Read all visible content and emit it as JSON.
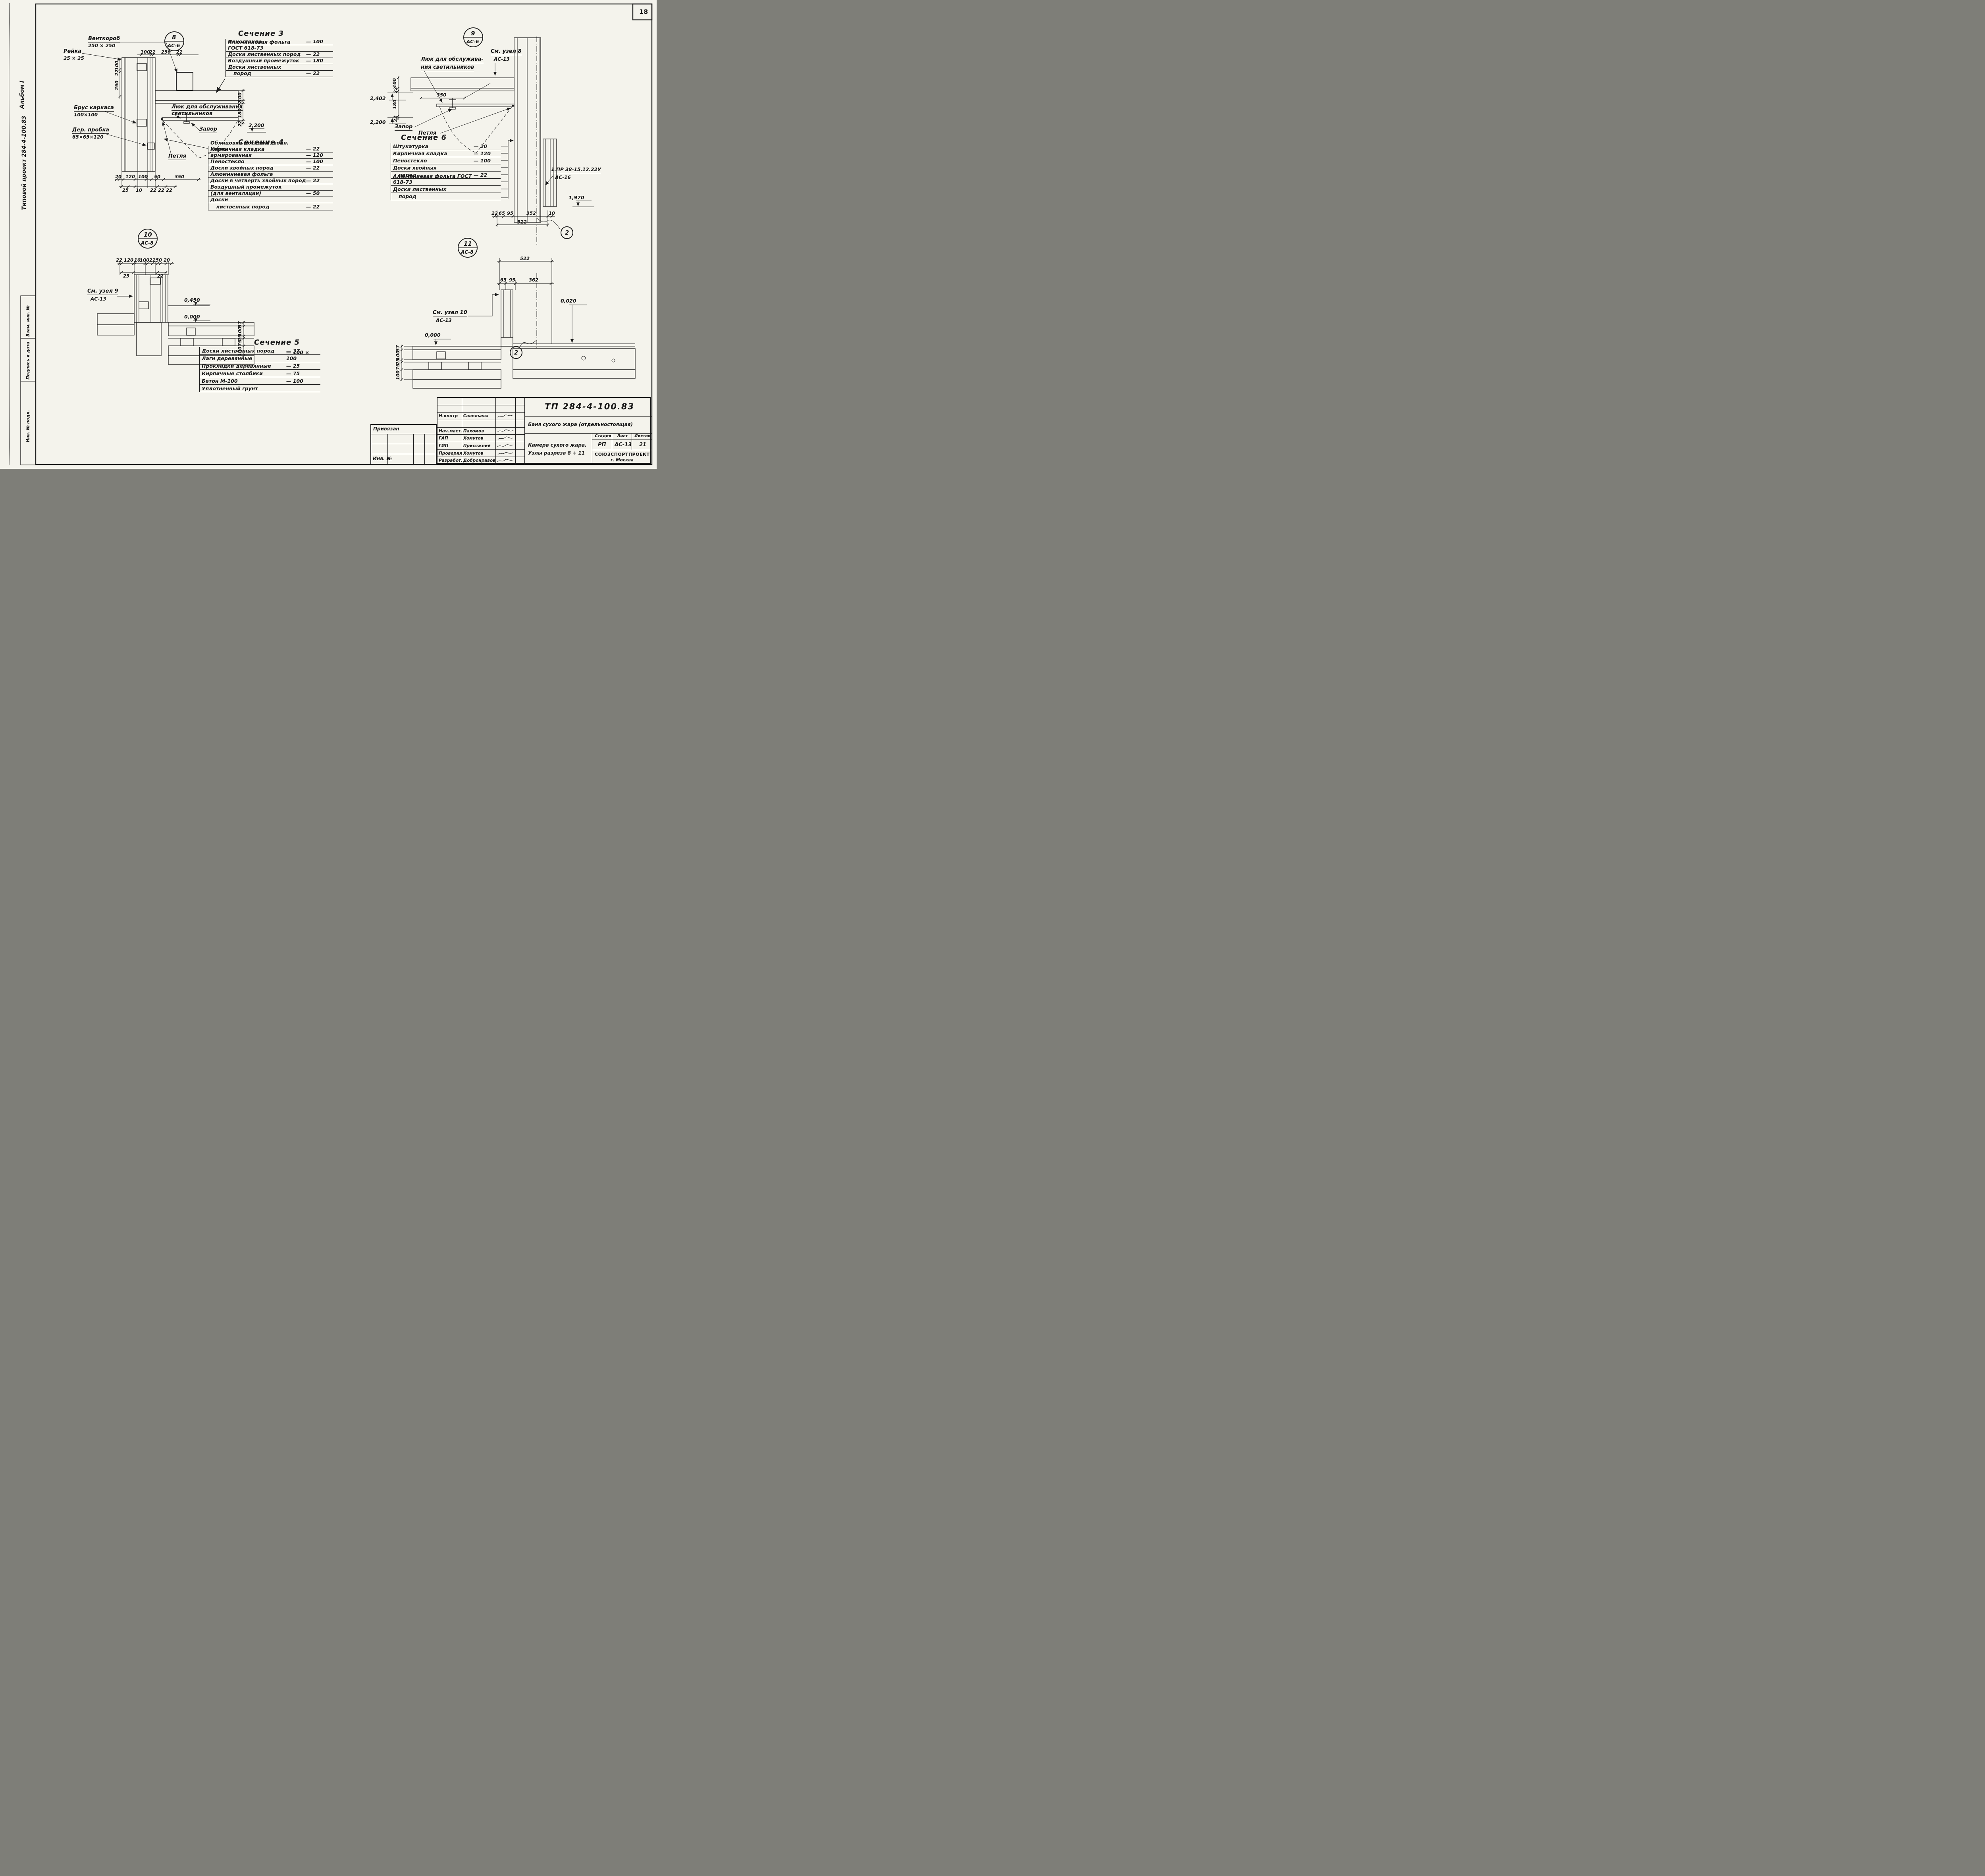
{
  "sheet": {
    "page_number": "18"
  },
  "margin": {
    "album": "Альбом I",
    "project": "Типовой проект 284-4-100.83",
    "stamp_cells": [
      "Взам. инв. №",
      "Подпись и дата",
      "Инв. № подл."
    ]
  },
  "sec3": {
    "title": "Сечение 3",
    "rows": [
      {
        "n": "Пеностекло",
        "v": "—  100"
      },
      {
        "n": "Алюминиевая фольга ГОСТ 618-73",
        "v": ""
      },
      {
        "n": "Доски лиственных пород",
        "v": "—  22"
      },
      {
        "n": "Воздушный промежуток",
        "v": "—  180"
      },
      {
        "n": "Доски  лиственных",
        "v": ""
      },
      {
        "n": "пород",
        "v": "—  22"
      }
    ]
  },
  "sec4": {
    "title": "Сечение 4",
    "rows": [
      {
        "n": "Облицовка досками хвойн. пород",
        "v": "—  22"
      },
      {
        "n": "Кирпичная кладка армированная",
        "v": "—  120"
      },
      {
        "n": "Пеностекло",
        "v": "—  100"
      },
      {
        "n": "Доски хвойных пород",
        "v": "—  22"
      },
      {
        "n": "Алюминиевая фольга",
        "v": ""
      },
      {
        "n": "Доски в четверть хвойных пород",
        "v": "—  22"
      },
      {
        "n": "Воздушный промежуток",
        "v": ""
      },
      {
        "n": "(для вентиляции)",
        "v": "—  50"
      },
      {
        "n": "Доски",
        "v": ""
      },
      {
        "n": "лиственных пород",
        "v": "—  22"
      }
    ]
  },
  "sec5": {
    "title": "Сечение 5",
    "rows": [
      {
        "n": "Доски лиственных пород",
        "v": "—  37"
      },
      {
        "n": "Лаги деревянные",
        "v": "— 100 × 100"
      },
      {
        "n": "Прокладки деревянные",
        "v": "—  25"
      },
      {
        "n": "Кирпичные столбики",
        "v": "—  75"
      },
      {
        "n": "Бетон  М-100",
        "v": "—  100"
      },
      {
        "n": "Уплотненный грунт",
        "v": ""
      }
    ]
  },
  "sec6": {
    "title": "Сечение 6",
    "rows": [
      {
        "n": "Штукатурка",
        "v": "—  20"
      },
      {
        "n": "Кирпичная кладка",
        "v": "—  120"
      },
      {
        "n": "Пеностекло",
        "v": "—  100"
      },
      {
        "n": "Доски хвойных",
        "v": ""
      },
      {
        "n": "пород",
        "v": "—  22"
      },
      {
        "n": "Алюминиевая фольга ГОСТ 618-73",
        "v": ""
      },
      {
        "n": "Доски  лиственных",
        "v": ""
      },
      {
        "n": "пород",
        "v": ""
      }
    ]
  },
  "node8": {
    "num": "8",
    "ref": "АС-6",
    "duct": "Венткороб",
    "duct_size": "250 × 250",
    "lath": "Рейка",
    "lath_size": "25 × 25",
    "beam": "Брус каркаса",
    "beam_size": "100×100",
    "plug": "Дер. пробка",
    "plug_size": "65×65×120",
    "hatch1": "Люк для обслуживания",
    "hatch2": "светильников",
    "latch": "Запор",
    "hinge": "Петля",
    "top_dims": [
      "100",
      "22",
      "250",
      "22"
    ],
    "left_dims": [
      "100",
      "22",
      "250"
    ],
    "right_dims": [
      "100",
      "22",
      "180",
      "22"
    ],
    "elev": "2,200",
    "bot_dims": [
      "20",
      "120",
      "100",
      "50",
      "350"
    ],
    "bot_dims2": [
      "25",
      "10",
      "22",
      "22",
      "22"
    ]
  },
  "node9": {
    "num": "9",
    "ref": "АС-6",
    "see": "См. узел 8",
    "see_ref": "АС-13",
    "hatch1": "Люк для обслужива-",
    "hatch2": "ния светильников",
    "latch": "Запор",
    "hinge": "Петля",
    "elev1": "2,402",
    "elev2": "2,200",
    "elev3": "1,970",
    "dim350": "350",
    "vdims": [
      "100",
      "22",
      "180",
      "22"
    ],
    "ref_doc": "1.ПР 38-15.12.22У",
    "ref_doc_sub": "АС-16",
    "bot_dims": [
      "22",
      "65",
      "95",
      "352",
      "10"
    ],
    "bot_total": "522",
    "axis": "2"
  },
  "node10": {
    "num": "10",
    "ref": "АС-8",
    "see": "См. узел 9",
    "see_ref": "АС-13",
    "elev1": "0,450",
    "elev2": "0,000",
    "top_dims": [
      "22",
      "120",
      "10",
      "100",
      "22",
      "50",
      "20"
    ],
    "top_dims2": [
      "25",
      "22"
    ],
    "vdims": [
      "37",
      "100",
      "25",
      "75",
      "100"
    ]
  },
  "node11": {
    "num": "11",
    "ref": "АС-8",
    "see": "См. узел 10",
    "see_ref": "АС-13",
    "elev1": "0,000",
    "elev2": "0,020",
    "dim_total": "522",
    "top_dims": [
      "65",
      "95",
      "362"
    ],
    "vdims": [
      "37",
      "100",
      "25",
      "75",
      "100"
    ],
    "axis": "2"
  },
  "tb": {
    "doc": "ТП 284-4-100.83",
    "object": "Баня сухого жара (отдельностоящая)",
    "drawing1": "Камера сухого жара.",
    "drawing2": "Узлы  разреза  8 ÷ 11",
    "stage_h": "Стадия",
    "sheet_h": "Лист",
    "sheets_h": "Листов",
    "stage": "РП",
    "sheet": "АС-13",
    "sheets": "21",
    "org": "СОЮЗСПОРТПРОЕКТ",
    "city": "г. Москва",
    "attached": "Привязан",
    "inv": "Инв. №",
    "roles": [
      {
        "r": "Н.контр",
        "n": "Савельева"
      },
      {
        "r": "Нач.маст.",
        "n": "Пахомов"
      },
      {
        "r": "ГАП",
        "n": "Хомутов"
      },
      {
        "r": "ГИП",
        "n": "Присяжний"
      },
      {
        "r": "Проверил",
        "n": "Хомутов"
      },
      {
        "r": "Разработ.",
        "n": "Добронравова"
      }
    ]
  }
}
